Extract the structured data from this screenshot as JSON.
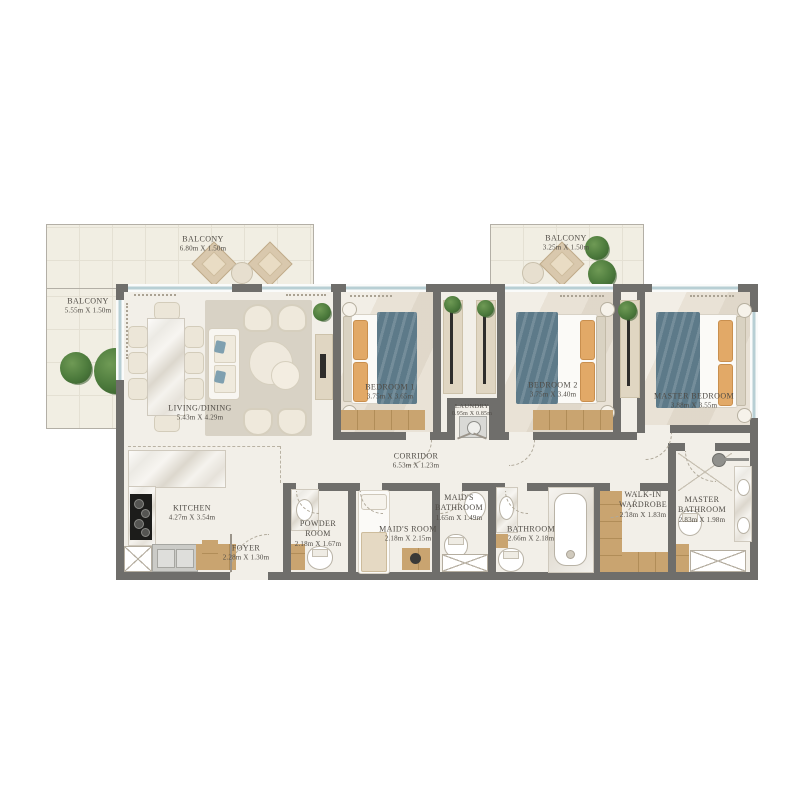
{
  "floorplan": {
    "rooms": [
      {
        "id": "balcony-top",
        "name": "BALCONY",
        "dims": "6.80m X 1.50m"
      },
      {
        "id": "balcony-left",
        "name": "BALCONY",
        "dims": "5.55m X 1.50m"
      },
      {
        "id": "balcony-right",
        "name": "BALCONY",
        "dims": "3.25m X 1.50m"
      },
      {
        "id": "living-dining",
        "name": "LIVING/DINING",
        "dims": "5.43m X 4.29m"
      },
      {
        "id": "bedroom-1",
        "name": "BEDROOM 1",
        "dims": "3.75m X 3.65m"
      },
      {
        "id": "laundry",
        "name": "LAUNDRY",
        "dims": "0.95m X 0.85m"
      },
      {
        "id": "bedroom-2",
        "name": "BEDROOM 2",
        "dims": "3.75m X 3.40m"
      },
      {
        "id": "master-bedroom",
        "name": "MASTER BEDROOM",
        "dims": "3.88m X 3.55m"
      },
      {
        "id": "corridor",
        "name": "CORRIDOR",
        "dims": "6.53m X 1.23m"
      },
      {
        "id": "kitchen",
        "name": "KITCHEN",
        "dims": "4.27m X 3.54m"
      },
      {
        "id": "foyer",
        "name": "FOYER",
        "dims": "2.28m X 1.30m"
      },
      {
        "id": "powder-room",
        "name": "POWDER ROOM",
        "dims": "2.18m X 1.67m"
      },
      {
        "id": "maids-room",
        "name": "MAID'S ROOM",
        "dims": "2.18m X 2.15m"
      },
      {
        "id": "maids-bathroom",
        "name": "MAID'S BATHROOM",
        "dims": "1.65m X 1.49m"
      },
      {
        "id": "bathroom",
        "name": "BATHROOM",
        "dims": "2.66m X 2.18m"
      },
      {
        "id": "walk-in-wardrobe",
        "name": "WALK-IN WARDROBE",
        "dims": "2.18m X 1.83m"
      },
      {
        "id": "master-bathroom",
        "name": "MASTER BATHROOM",
        "dims": "2.83m X 1.98m"
      }
    ],
    "colors": {
      "wall": "#6f6e6b",
      "floor": "#f2efe8",
      "balcony_floor": "#f1eee3",
      "wood": "#c9a470",
      "blanket": "#5d7a89",
      "pillow": "#e2a967",
      "rug": "#d8d2c5",
      "window": "#b8cfd4",
      "plant": "#4c7a3c",
      "label_text": "#4f4b45"
    }
  }
}
